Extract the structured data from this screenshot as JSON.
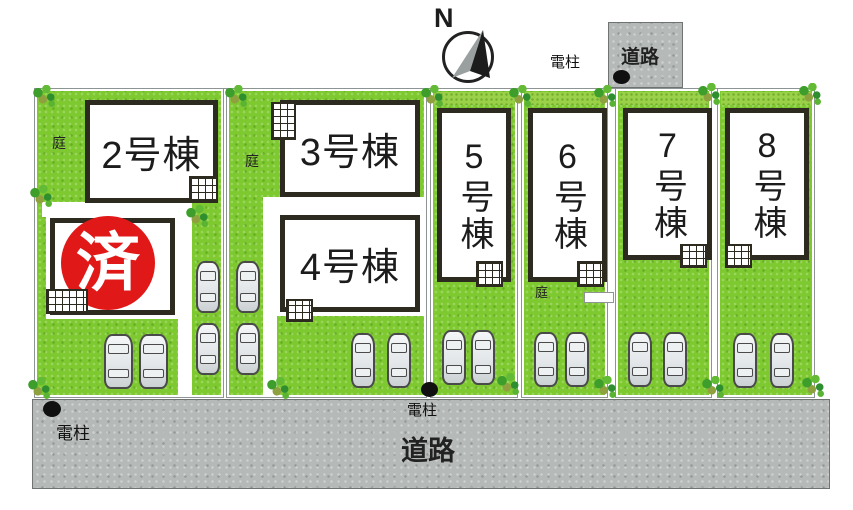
{
  "compass_n": "N",
  "roads": {
    "top": "道路",
    "bottom": "道路"
  },
  "pole_label": "電柱",
  "garden_label": "庭",
  "sold_mark": "済",
  "buildings": {
    "b2": "2号棟",
    "b3": "3号棟",
    "b4": "4号棟",
    "b5": "5号棟",
    "b6": "6号棟",
    "b7": "7号棟",
    "b8": "8号棟"
  },
  "colors": {
    "grass": "#7fc930",
    "hedge": "#9ad148",
    "road": "#b5b9b8",
    "sold_red": "#e11818",
    "building_border": "#2d2a20"
  }
}
